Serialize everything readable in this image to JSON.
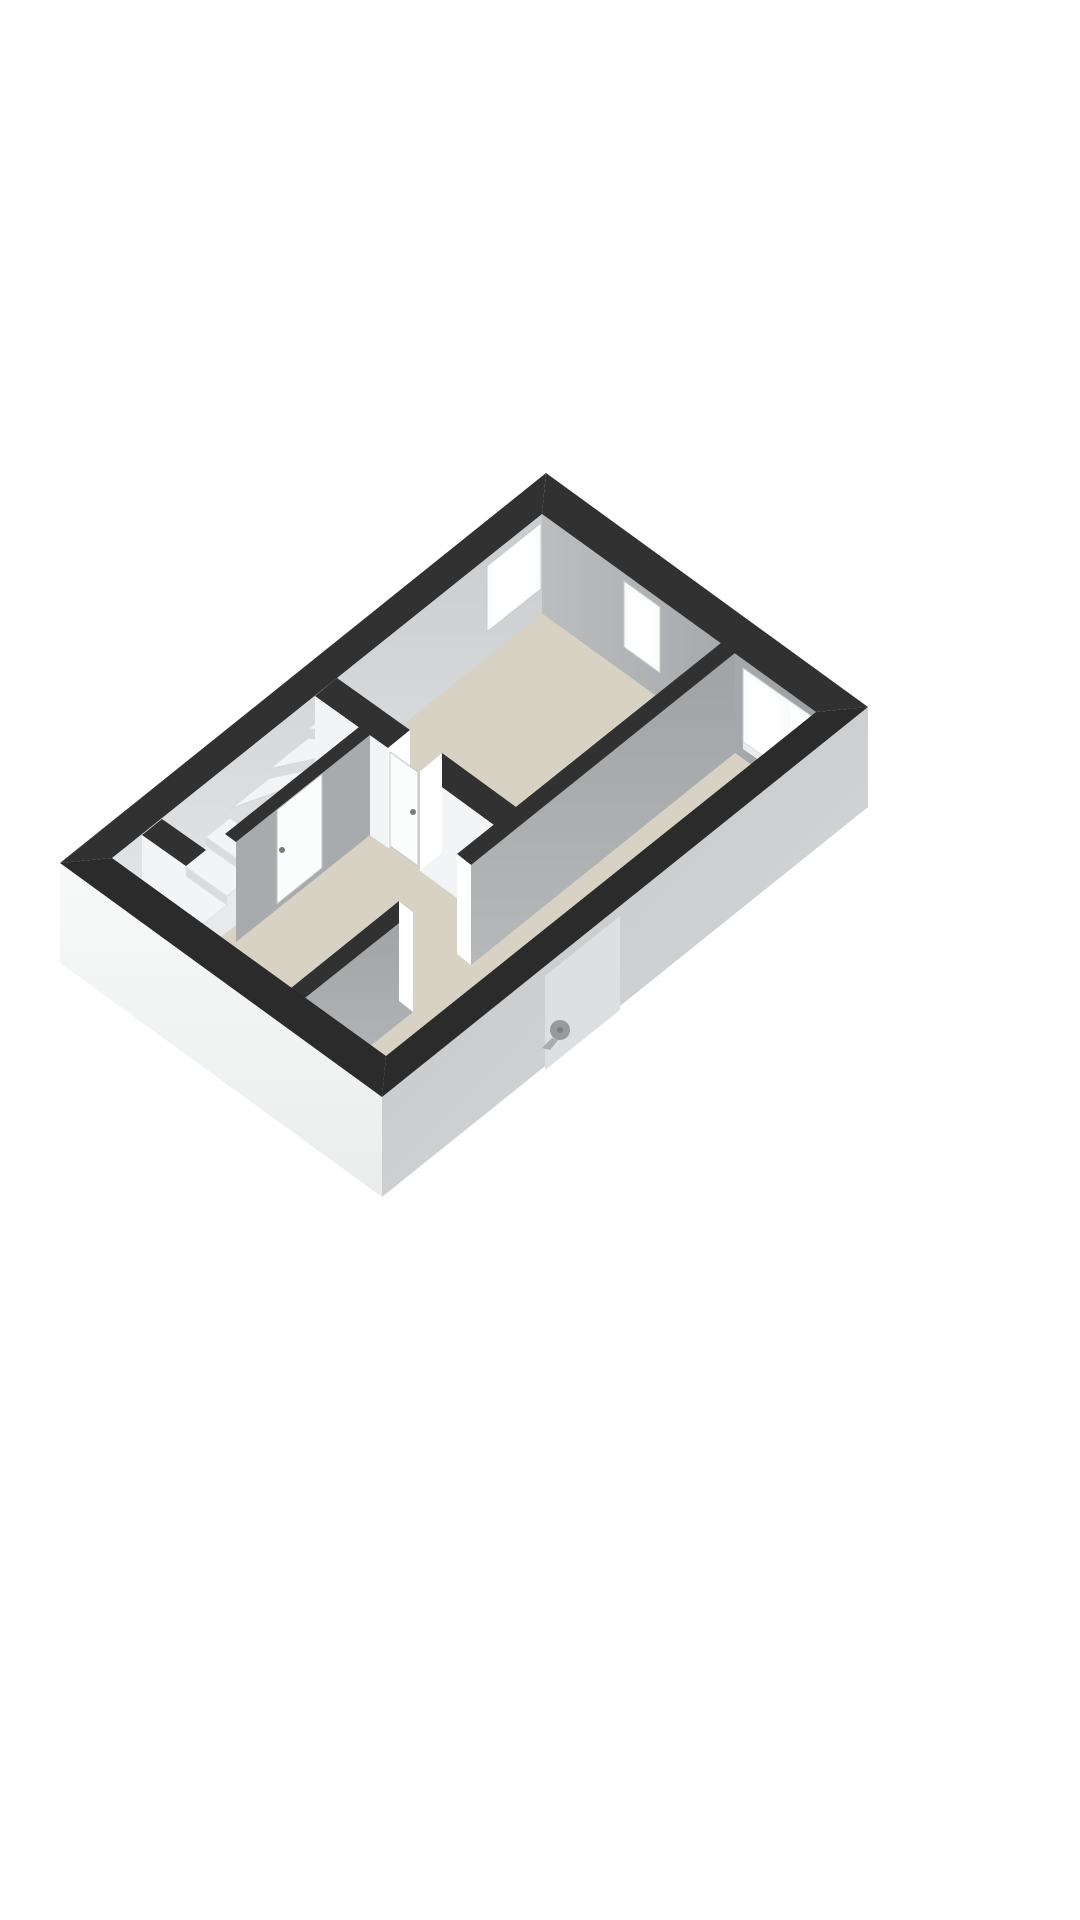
{
  "view": {
    "type": "floorplan-3d-render",
    "background": "#ffffff",
    "floor_count_visible": 1
  },
  "palette": {
    "background": "#ffffff",
    "wall_top": "#313131",
    "wall_top_near": "#2b2b2b",
    "nw_inner_face": "#d4d6d8",
    "ne_inner_face": "#aaacae",
    "interior_gray_face": "#a8aaac",
    "interior_white_face": "#f3f4f5",
    "sw_outer_face": "#f5f6f6",
    "se_outer_face": "#ced0d2",
    "floor": "#d7d2c4",
    "stairwell_floor": "#e8e9ea",
    "stair_tread": "#f3f4f5",
    "stair_riser": "#d9dbdd",
    "window_frame": "#fafbfb",
    "window_glass": "#ffffff",
    "door_leaf": "#fbfcfc",
    "door_handle": "#7a7d7f",
    "knob": "#97999b"
  },
  "scene": {
    "rooms_visible": 4,
    "windows": 3,
    "door_leaves": 2,
    "door_openings": 2,
    "stair_steps": 9,
    "stair_type": "winder"
  },
  "icons": {
    "knob_icon": "door-knob"
  }
}
